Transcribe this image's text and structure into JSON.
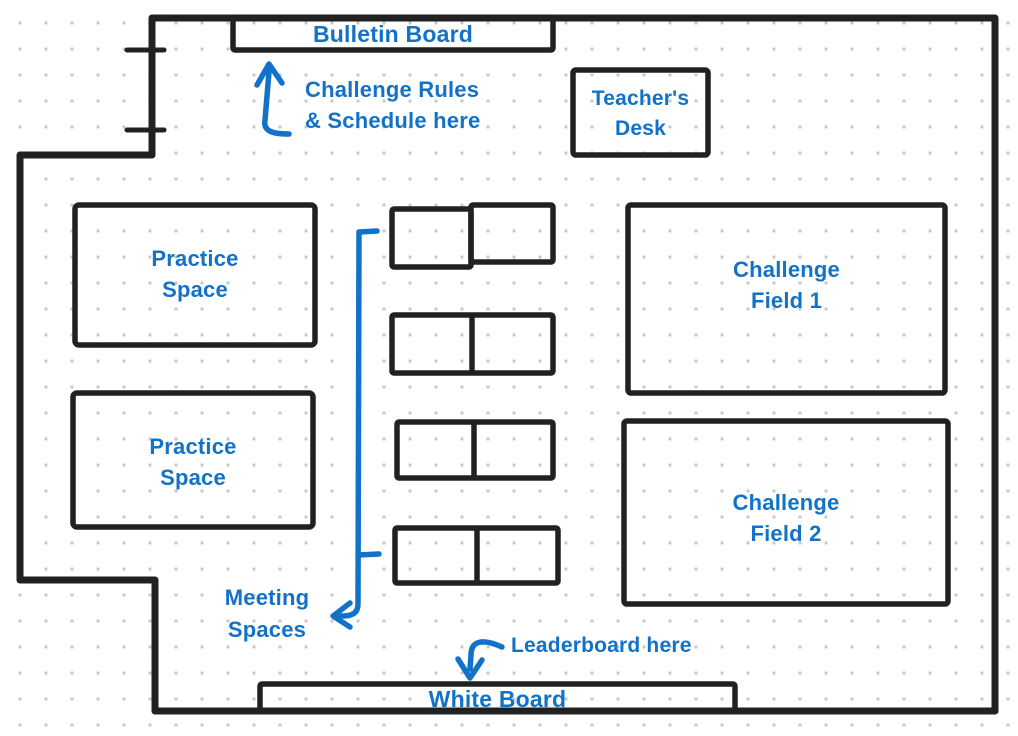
{
  "colors": {
    "annotation_blue": "#1272c8",
    "wall_black": "#212121",
    "grid_dot_gray": "#c9c9c9"
  },
  "areas": {
    "bulletin_board": {
      "label": "Bulletin Board"
    },
    "teachers_desk": {
      "line1": "Teacher's",
      "line2": "Desk"
    },
    "practice_space_1": {
      "line1": "Practice",
      "line2": "Space"
    },
    "practice_space_2": {
      "line1": "Practice",
      "line2": "Space"
    },
    "challenge_field_1": {
      "line1": "Challenge",
      "line2": "Field 1"
    },
    "challenge_field_2": {
      "line1": "Challenge",
      "line2": "Field 2"
    },
    "white_board": {
      "label": "White Board"
    },
    "meeting_tables_count": 4
  },
  "annotations": {
    "challenge_rules": {
      "line1": "Challenge Rules",
      "line2": "& Schedule here"
    },
    "meeting_spaces": {
      "line1": "Meeting",
      "line2": "Spaces"
    },
    "leaderboard": {
      "label": "Leaderboard here"
    }
  }
}
